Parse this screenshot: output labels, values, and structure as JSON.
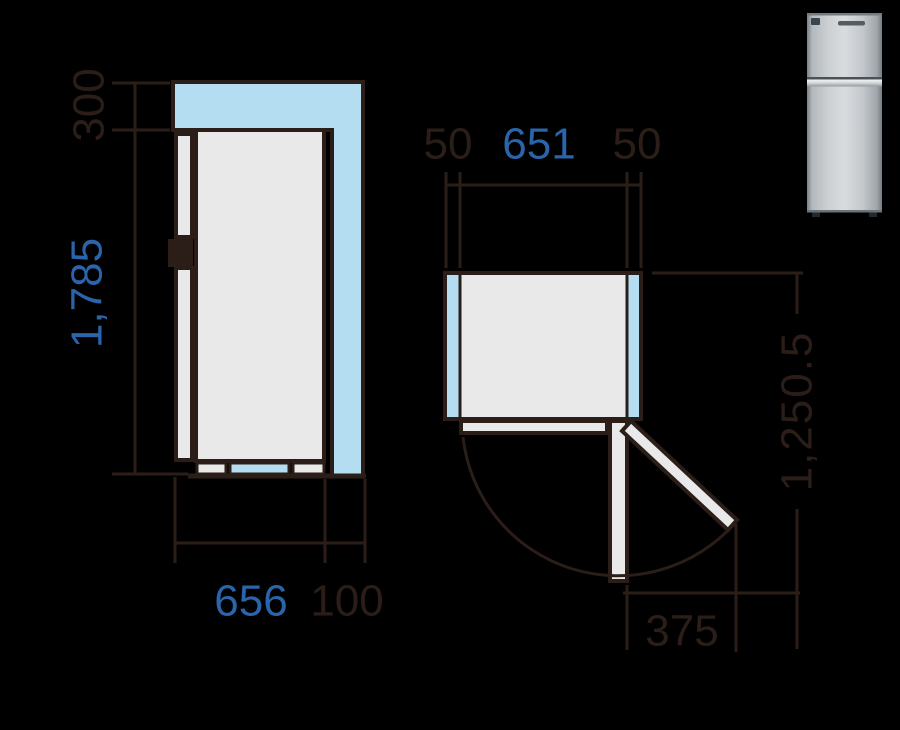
{
  "figure": {
    "title": "refrigerator-installation-clearance-diagram",
    "unit_note": "millimetres (as depicted)"
  },
  "side_view": {
    "top_clearance": "300",
    "height": "1,785",
    "depth": "656",
    "rear_clearance": "100"
  },
  "top_view": {
    "left_clearance": "50",
    "width": "651",
    "right_clearance": "50",
    "depth_door_open": "1,250.5",
    "door_swing": "375"
  },
  "product_photo": {
    "description": "silver top-freezer refrigerator, front view, brand mark and feature mark on upper door"
  },
  "colors": {
    "background": "#000000",
    "clearance_blue": "#b5ddf1",
    "body_gray": "#e9e9e9",
    "outline_dark": "#2b1e19",
    "dim_text_dark": "#2b1e19",
    "dim_text_blue": "#2a64ab",
    "fridge_silver_light": "#d9dcde",
    "fridge_silver_dark": "#878e94"
  }
}
